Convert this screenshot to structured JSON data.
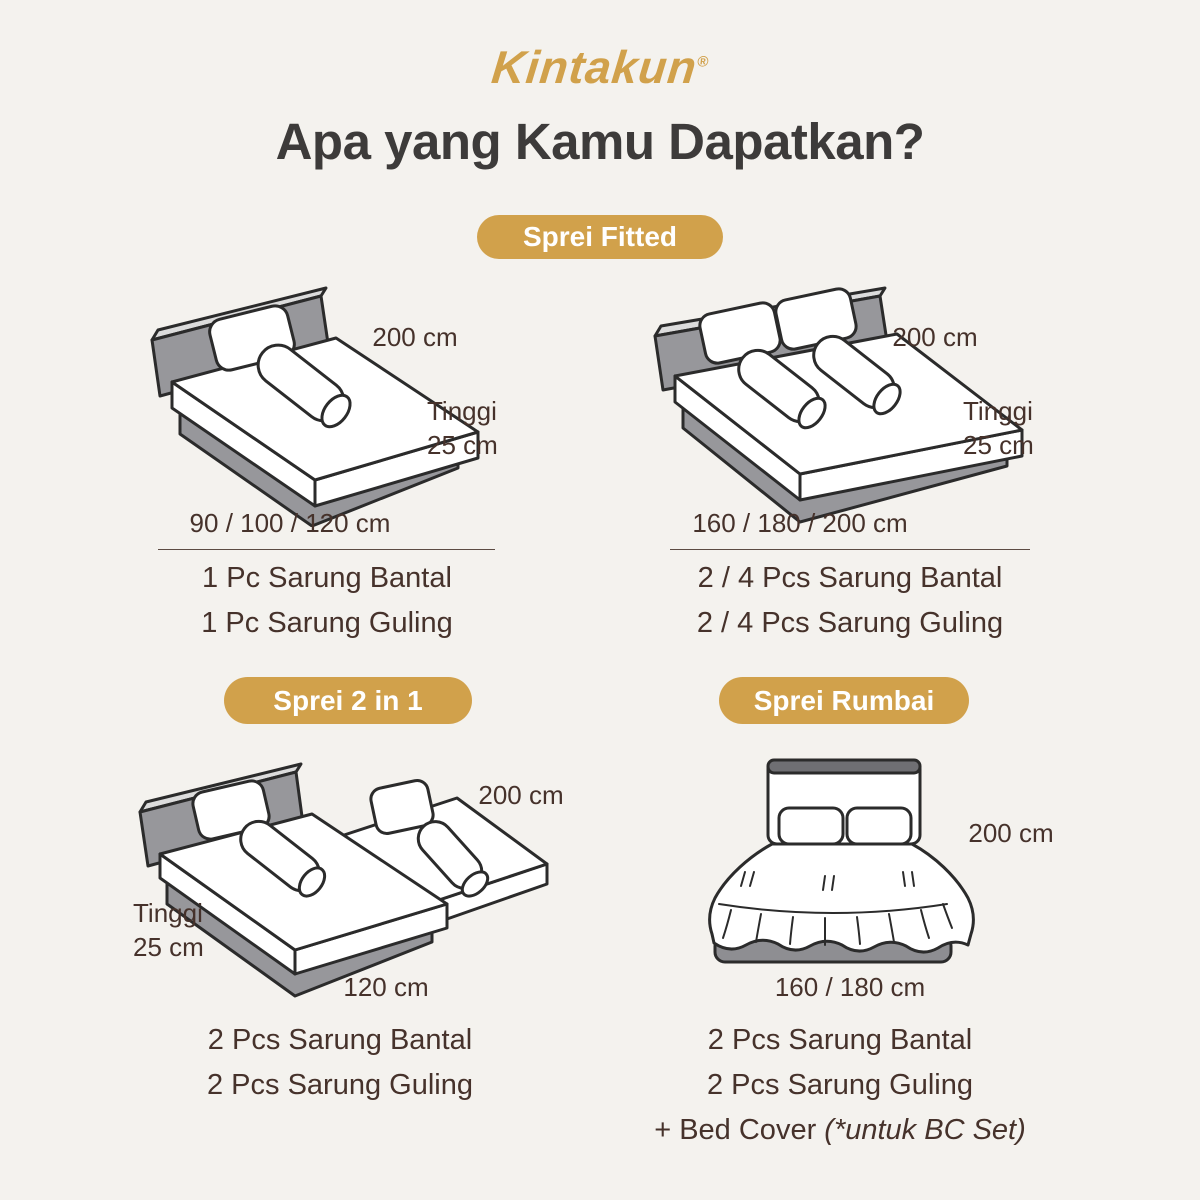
{
  "brand": {
    "name": "Kintakun",
    "reg": "®"
  },
  "title": "Apa yang Kamu Dapatkan?",
  "badges": {
    "fitted": "Sprei Fitted",
    "two_in_one": "Sprei 2 in 1",
    "rumbai": "Sprei Rumbai"
  },
  "fitted_single": {
    "length": "200 cm",
    "height": "Tinggi\n25 cm",
    "sizes": "90 / 100 / 120 cm",
    "items": [
      "1 Pc Sarung Bantal",
      "1 Pc Sarung Guling"
    ]
  },
  "fitted_double": {
    "length": "200 cm",
    "height": "Tinggi\n25 cm",
    "sizes": "160 / 180 / 200 cm",
    "items": [
      "2 / 4 Pcs Sarung Bantal",
      "2 / 4 Pcs Sarung Guling"
    ]
  },
  "two_in_one": {
    "length": "200 cm",
    "height": "Tinggi\n25 cm",
    "sizes": "120 cm",
    "items": [
      "2 Pcs Sarung Bantal",
      "2 Pcs Sarung Guling"
    ]
  },
  "rumbai": {
    "length": "200 cm",
    "sizes": "160 / 180 cm",
    "items": [
      "2 Pcs Sarung Bantal",
      "2 Pcs Sarung Guling"
    ],
    "extra_prefix": "+ Bed Cover ",
    "extra_italic": "(*untuk BC Set)"
  },
  "colors": {
    "background": "#F4F2EE",
    "brand_gold": "#D1A14B",
    "title_text": "#3D3B3A",
    "body_text": "#46322B",
    "bed_gray": "#97979B",
    "outline": "#2B2B2B"
  }
}
